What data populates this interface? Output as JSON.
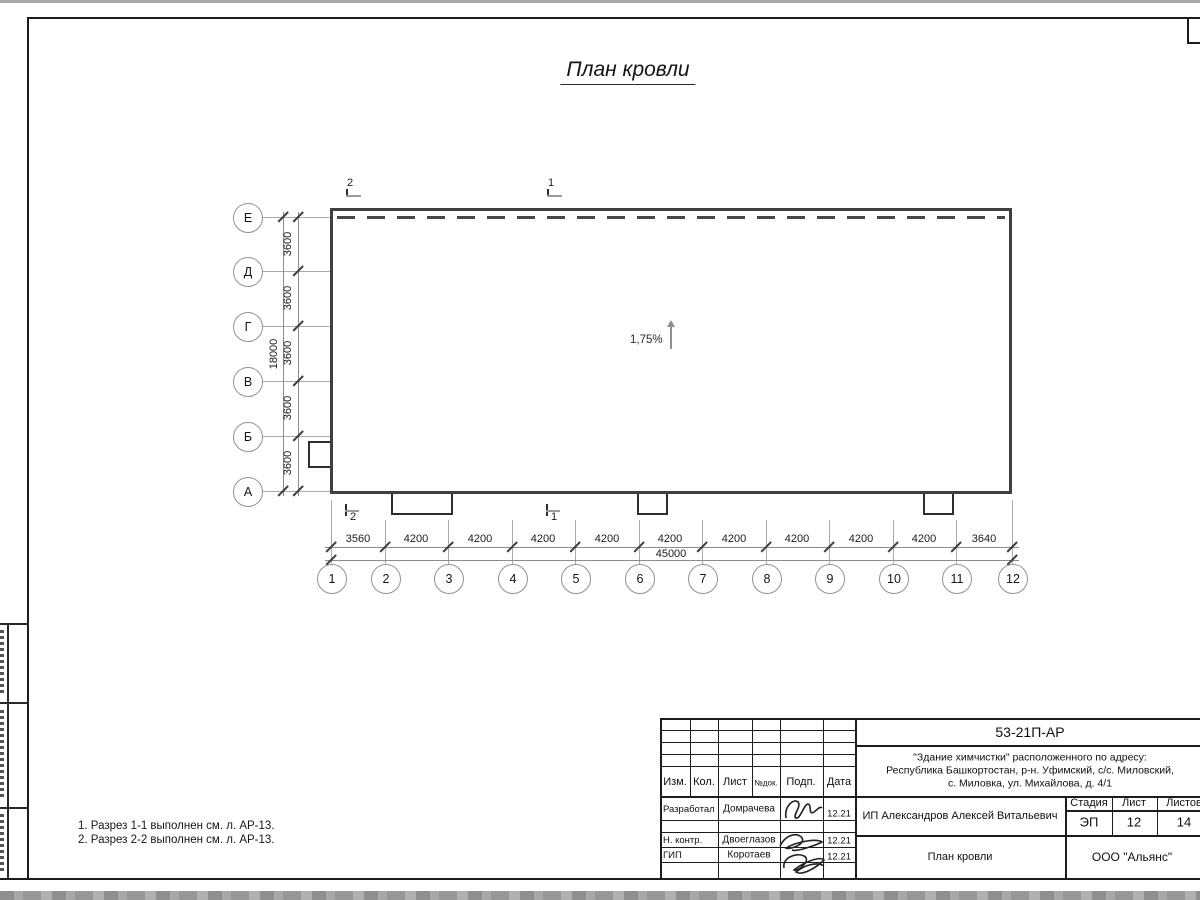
{
  "title": "План кровли",
  "plan": {
    "slope_label": "1,75%",
    "row_axes": [
      "Е",
      "Д",
      "Г",
      "В",
      "Б",
      "А"
    ],
    "row_dims": [
      "3600",
      "3600",
      "3600",
      "3600",
      "3600"
    ],
    "row_total": "18000",
    "col_axes": [
      "1",
      "2",
      "3",
      "4",
      "5",
      "6",
      "7",
      "8",
      "9",
      "10",
      "11",
      "12"
    ],
    "col_dims": [
      "3560",
      "4200",
      "4200",
      "4200",
      "4200",
      "4200",
      "4200",
      "4200",
      "4200",
      "4200",
      "3640"
    ],
    "col_total": "45000",
    "section_top_left": "2",
    "section_top_right": "1",
    "section_bottom_left": "2",
    "section_bottom_right": "1"
  },
  "notes": {
    "line1": "1. Разрез 1-1 выполнен см. л. АР-13.",
    "line2": "2. Разрез 2-2 выполнен см. л. АР-13."
  },
  "title_block": {
    "doc_number": "53-21П-АР",
    "address_line1": "\"Здание химчистки\" расположенного по адресу:",
    "address_line2": "Республика Башкортостан, р-н. Уфимский, с/с. Миловский,",
    "address_line3": "с. Миловка, ул. Михайлова, д. 4/1",
    "col_izm": "Изм.",
    "col_kol": "Кол.",
    "col_list": "Лист",
    "col_ndok": "№док.",
    "col_podp": "Подп.",
    "col_data": "Дата",
    "row1_role": "Разработал",
    "row1_name": "Домрачева",
    "row1_date": "12.21",
    "row2_role": "Н. контр.",
    "row2_name": "Двоеглазов",
    "row2_date": "12.21",
    "row3_role": "ГИП",
    "row3_name": "Коротаев",
    "row3_date": "12.21",
    "client": "ИП Александров Алексей Витальевич",
    "stage_label": "Стадия",
    "sheet_label": "Лист",
    "sheets_label": "Листов",
    "stage_value": "ЭП",
    "sheet_value": "12",
    "sheets_value": "14",
    "sheet_title": "План кровли",
    "company": "ООО \"Альянс\""
  },
  "colors": {
    "line_dark": "#1c1c1c",
    "building_outline": "#3f3f3f",
    "dim_line": "#8c8c8c",
    "scan_band": "#9b9b9b"
  }
}
